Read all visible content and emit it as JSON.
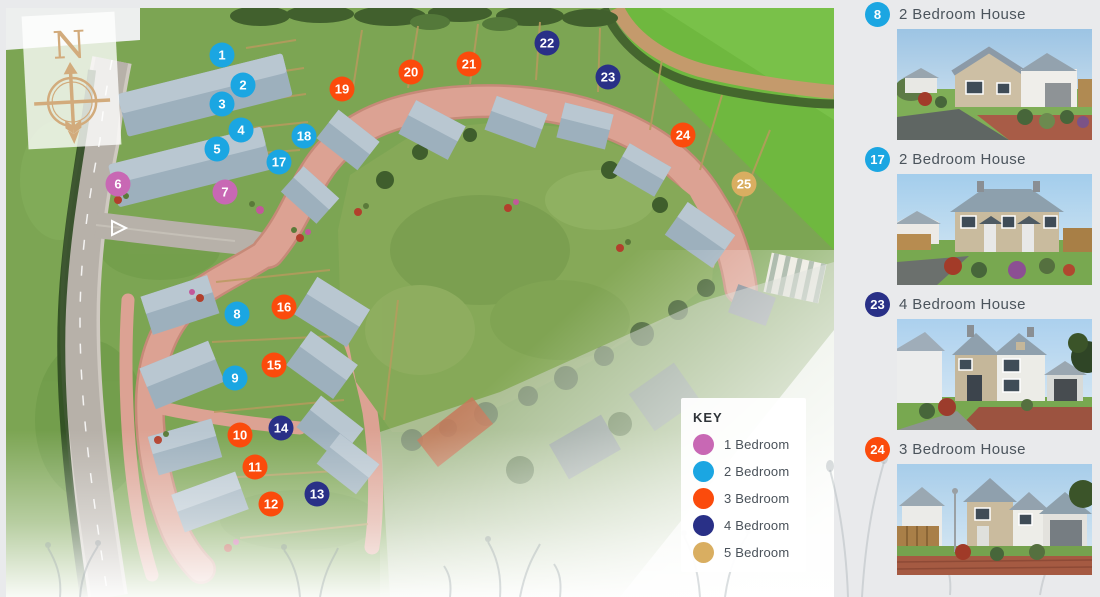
{
  "colors": {
    "1": "#c868b4",
    "2": "#1ba6e2",
    "3": "#fb4b0c",
    "4": "#293087",
    "5": "#d9ae61"
  },
  "compass": {
    "north_label": "N"
  },
  "key": {
    "title": "KEY",
    "items": [
      {
        "bedrooms": 1,
        "label": "1 Bedroom"
      },
      {
        "bedrooms": 2,
        "label": "2 Bedroom"
      },
      {
        "bedrooms": 3,
        "label": "3 Bedroom"
      },
      {
        "bedrooms": 4,
        "label": "4 Bedroom"
      },
      {
        "bedrooms": 5,
        "label": "5 Bedroom"
      }
    ]
  },
  "markers": [
    {
      "plot": 1,
      "bedrooms": 2,
      "x": 222,
      "y": 55
    },
    {
      "plot": 2,
      "bedrooms": 2,
      "x": 243,
      "y": 85
    },
    {
      "plot": 3,
      "bedrooms": 2,
      "x": 222,
      "y": 104
    },
    {
      "plot": 4,
      "bedrooms": 2,
      "x": 241,
      "y": 130
    },
    {
      "plot": 5,
      "bedrooms": 2,
      "x": 217,
      "y": 149
    },
    {
      "plot": 6,
      "bedrooms": 1,
      "x": 118,
      "y": 184
    },
    {
      "plot": 7,
      "bedrooms": 1,
      "x": 225,
      "y": 192
    },
    {
      "plot": 8,
      "bedrooms": 2,
      "x": 237,
      "y": 314
    },
    {
      "plot": 9,
      "bedrooms": 2,
      "x": 235,
      "y": 378
    },
    {
      "plot": 10,
      "bedrooms": 3,
      "x": 240,
      "y": 435
    },
    {
      "plot": 11,
      "bedrooms": 3,
      "x": 255,
      "y": 467
    },
    {
      "plot": 12,
      "bedrooms": 3,
      "x": 271,
      "y": 504
    },
    {
      "plot": 13,
      "bedrooms": 4,
      "x": 317,
      "y": 494
    },
    {
      "plot": 14,
      "bedrooms": 4,
      "x": 281,
      "y": 428
    },
    {
      "plot": 15,
      "bedrooms": 3,
      "x": 274,
      "y": 365
    },
    {
      "plot": 16,
      "bedrooms": 3,
      "x": 284,
      "y": 307
    },
    {
      "plot": 17,
      "bedrooms": 2,
      "x": 279,
      "y": 162
    },
    {
      "plot": 18,
      "bedrooms": 2,
      "x": 304,
      "y": 136
    },
    {
      "plot": 19,
      "bedrooms": 3,
      "x": 342,
      "y": 89
    },
    {
      "plot": 20,
      "bedrooms": 3,
      "x": 411,
      "y": 72
    },
    {
      "plot": 21,
      "bedrooms": 3,
      "x": 469,
      "y": 64
    },
    {
      "plot": 22,
      "bedrooms": 4,
      "x": 547,
      "y": 43
    },
    {
      "plot": 23,
      "bedrooms": 4,
      "x": 608,
      "y": 77
    },
    {
      "plot": 24,
      "bedrooms": 3,
      "x": 683,
      "y": 135
    },
    {
      "plot": 25,
      "bedrooms": 5,
      "x": 744,
      "y": 184
    }
  ],
  "sidebar": {
    "items": [
      {
        "plot": 8,
        "bedrooms": 2,
        "label": "2 Bedroom House"
      },
      {
        "plot": 17,
        "bedrooms": 2,
        "label": "2 Bedroom House"
      },
      {
        "plot": 23,
        "bedrooms": 4,
        "label": "4 Bedroom House"
      },
      {
        "plot": 24,
        "bedrooms": 3,
        "label": "3 Bedroom House"
      }
    ]
  }
}
